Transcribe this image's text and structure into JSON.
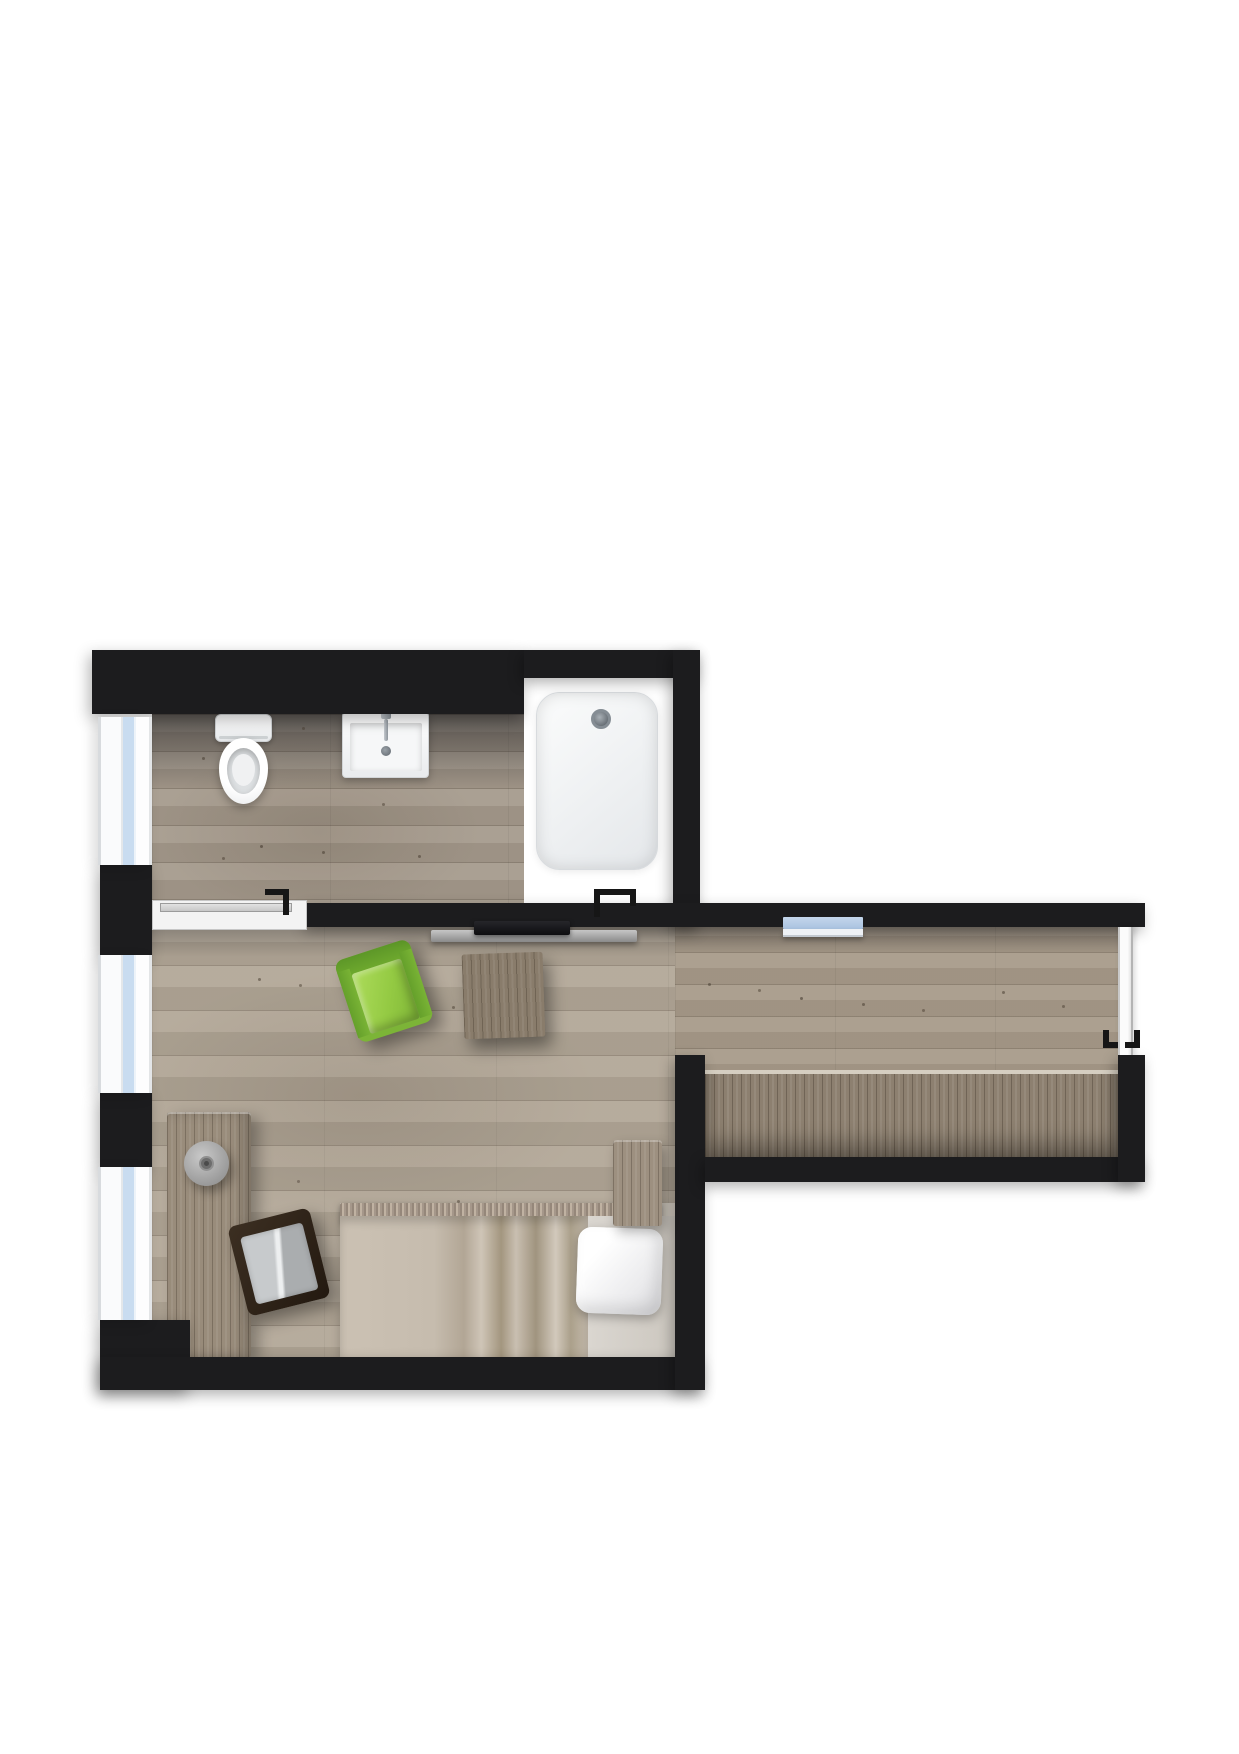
{
  "image_type": "floor-plan",
  "plan": {
    "shape": "studio apartment, top-down render, no text labels",
    "rooms": [
      {
        "id": "bathroom",
        "position": "top-left",
        "fixtures": [
          {
            "name": "toilet"
          },
          {
            "name": "washbasin",
            "details": [
              "faucet",
              "drain"
            ]
          },
          {
            "name": "shower",
            "details": [
              "tray",
              "drain"
            ]
          }
        ]
      },
      {
        "id": "main-room",
        "position": "left-bottom",
        "furniture": [
          {
            "name": "tv",
            "color": "#101013"
          },
          {
            "name": "tv-lowboard",
            "color": "#9b9b9b"
          },
          {
            "name": "armchair",
            "color": "#8bc43c"
          },
          {
            "name": "side-table",
            "color": "#897c6b"
          },
          {
            "name": "desk",
            "color": "#998c7b"
          },
          {
            "name": "stool",
            "color": "#a9a9a9"
          },
          {
            "name": "desk-chair",
            "frame_color": "#2f241a",
            "cushion_color": "#c0c3c5"
          },
          {
            "name": "bed",
            "duvet_color": "#c6bcae",
            "pillow_color": "#ffffff"
          },
          {
            "name": "headboard-cabinet",
            "color": "#9d9080"
          }
        ]
      },
      {
        "id": "hallway",
        "position": "right-wing",
        "furniture": [
          {
            "name": "wall-shelf",
            "color": "#b5cbe5"
          },
          {
            "name": "built-in-wardrobe",
            "color": "#8d8070"
          }
        ]
      }
    ],
    "openings": [
      {
        "name": "bathroom-sliding-door",
        "wall": "between bathroom and main room"
      },
      {
        "name": "entrance-door",
        "wall": "right end of hallway"
      },
      {
        "name": "window",
        "count": 3,
        "wall": "left outer wall"
      }
    ],
    "palette": {
      "background": "#ffffff",
      "wall": "#1c1c1e",
      "bathroom_floor": "#a59a8c",
      "main_room_floor": "#b2a797",
      "hallway_floor": "#a89b8a",
      "wardrobe_wood": "#8d8070",
      "window_glass": "#c9dcf0",
      "window_frame": "#fafbfc",
      "shower_tray": "#eef0f2",
      "armchair_green": "#8bc43c",
      "duvet_tan": "#c6bcae",
      "door_sill": "#f3f3f3"
    }
  }
}
